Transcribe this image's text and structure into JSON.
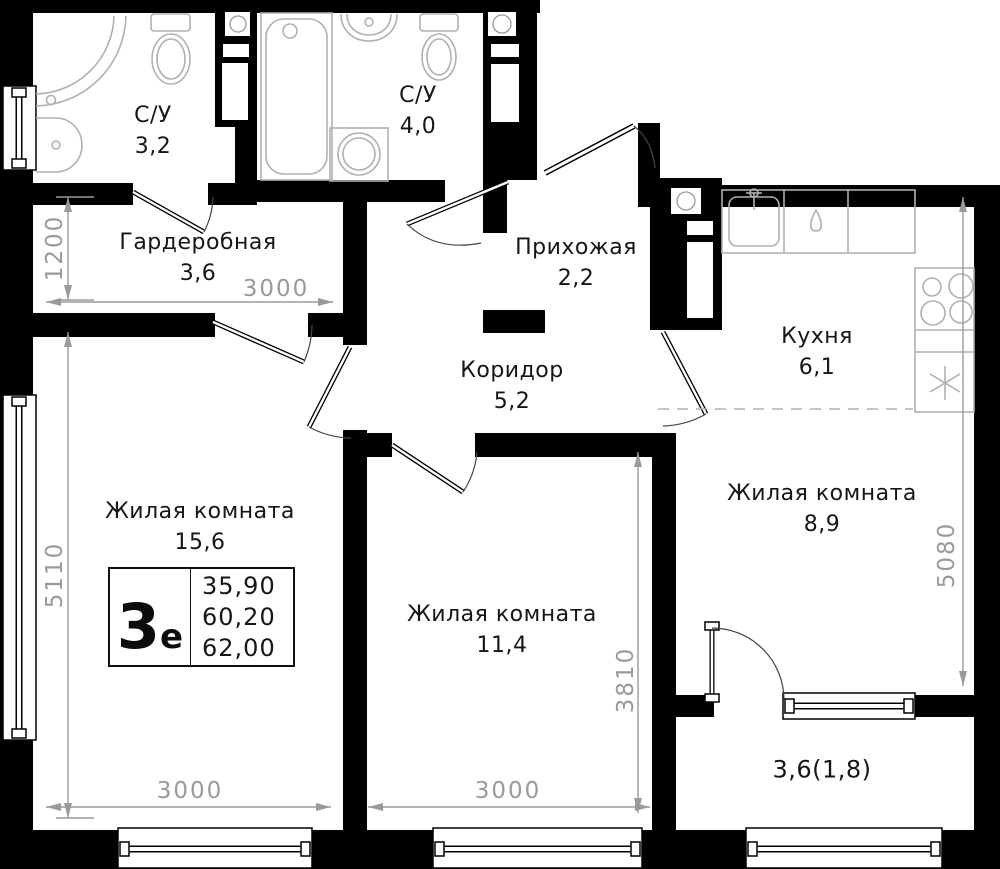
{
  "plan": {
    "unit_stamp": {
      "type_label": "3",
      "type_sub": "е",
      "values": [
        "35,90",
        "60,20",
        "62,00"
      ]
    },
    "rooms": [
      {
        "id": "bathroom-1",
        "name": "С/У",
        "area": "3,2"
      },
      {
        "id": "bathroom-2",
        "name": "С/У",
        "area": "4,0"
      },
      {
        "id": "wardrobe",
        "name": "Гардеробная",
        "area": "3,6"
      },
      {
        "id": "hallway",
        "name": "Прихожая",
        "area": "2,2"
      },
      {
        "id": "corridor",
        "name": "Коридор",
        "area": "5,2"
      },
      {
        "id": "kitchen",
        "name": "Кухня",
        "area": "6,1"
      },
      {
        "id": "living-room-1",
        "name": "Жилая комната",
        "area": "15,6"
      },
      {
        "id": "living-room-2",
        "name": "Жилая комната",
        "area": "11,4"
      },
      {
        "id": "living-room-3",
        "name": "Жилая комната",
        "area": "8,9"
      },
      {
        "id": "balcony",
        "name": "",
        "area": "3,6(1,8)"
      }
    ],
    "dims": {
      "wardrobe_h": "1200",
      "wardrobe_w": "3000",
      "living1_h": "5110",
      "living1_w": "3000",
      "living2_w": "3000",
      "living2_h": "3810",
      "living3_h": "5080"
    },
    "colors": {
      "wall": "#000000",
      "fixture": "#b0b0b0",
      "dimension": "#9a9a9a",
      "text": "#161616",
      "bg": "#ffffff"
    }
  }
}
